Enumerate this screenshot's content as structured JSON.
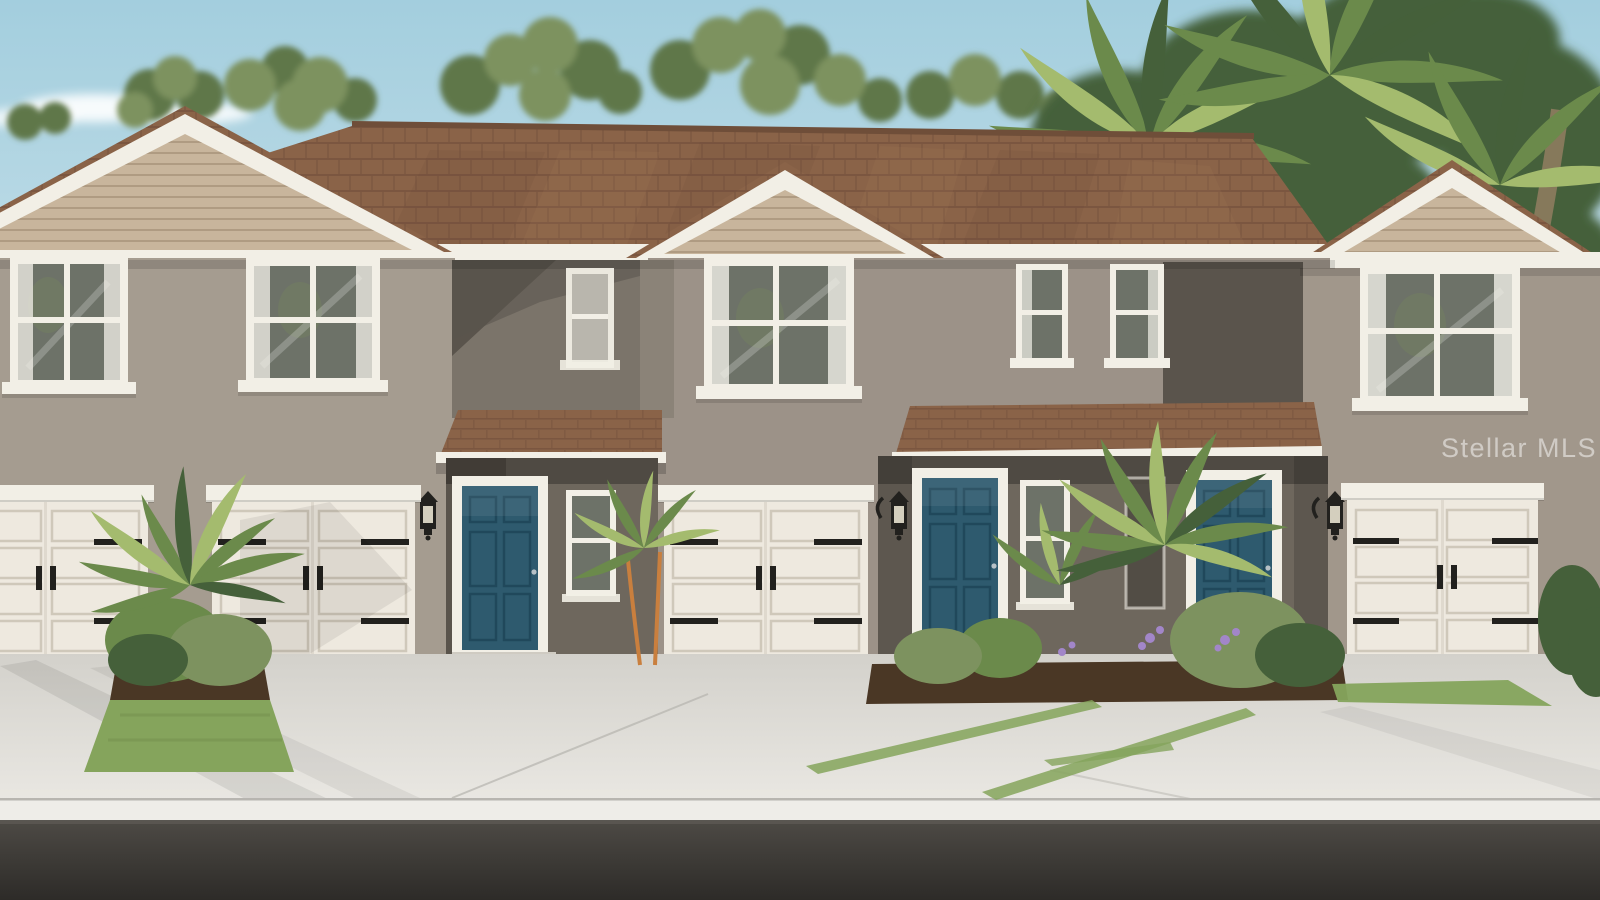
{
  "watermark": {
    "text": "Stellar MLS"
  },
  "scene": {
    "setting": "Rendering of two-story stucco townhomes with palm landscaping, concrete driveway and street",
    "sky": "clear light blue with soft clouds",
    "vegetation": [
      "deciduous trees",
      "palm trees",
      "ornamental palms",
      "shrubs",
      "purple flowers",
      "lawn patches",
      "mulch beds"
    ],
    "building": {
      "stories": 2,
      "wall_finish": "stucco",
      "roof": "brown asphalt shingle",
      "gables": 3,
      "gable_accent": "horizontal lap siding",
      "trim_color_name": "white",
      "entry_doors": {
        "count": 3,
        "style": "six-panel",
        "color_name": "teal blue"
      },
      "garage_doors": {
        "count": 4,
        "style": "carriage panels with black strap hinges",
        "color_name": "cream white"
      },
      "wall_lanterns": 3,
      "upper_windows": 7,
      "porch_windows": 3
    },
    "foreground": {
      "driveway": "light concrete with joint lines",
      "curb": "concrete sidewalk strip",
      "road": "dark asphalt"
    }
  },
  "palette": {
    "sky-top": "#a3cede",
    "sky-bottom": "#d8e9ef",
    "cloud": "#ffffff",
    "tree-green": "#7d925f",
    "tree-dark": "#5f774a",
    "palm-green": "#6b8a4b",
    "palm-dark": "#45603a",
    "palm-light": "#a4bb6e",
    "trunk": "#8d7c5f",
    "red-shrub": "#8a4a35",
    "roof-brown": "#8a6348",
    "roof-dark": "#6b4a37",
    "roof-light": "#a8835d",
    "trim": "#f2efe6",
    "siding": "#c8b59c",
    "siding-line": "#ab977e",
    "wall-left": "#a59c90",
    "wall-center": "#9c9288",
    "wall-right": "#a1978b",
    "wall-dark": "#5a544c",
    "recess": "#7b746a",
    "porch-shadow": "#6e675d",
    "door-teal": "#2e5a6e",
    "door-teal-dark": "#20485b",
    "garage-white": "#eee9df",
    "garage-line": "#cfc8ba",
    "hardware": "#22211e",
    "glass": "#6d7268",
    "curtain": "#f4f2ea",
    "driveway-top": "#d3d1cb",
    "driveway-bottom": "#e9e7e2",
    "curb": "#eeede8",
    "road-top": "#4d4a45",
    "road-bottom": "#2d2b28",
    "mulch": "#4a3725",
    "grass": "#85a45c",
    "flower": "#a286c9",
    "watermark": "#ffffff"
  }
}
